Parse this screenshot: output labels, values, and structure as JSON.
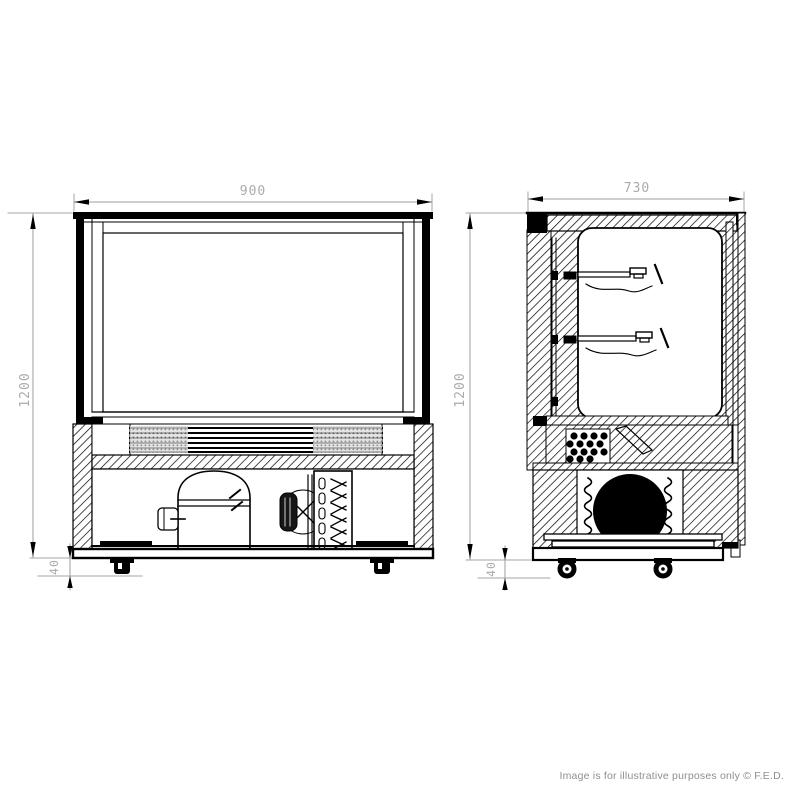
{
  "colors": {
    "background": "#ffffff",
    "drawing_line": "#000000",
    "dimension_gray": "#a6a6a6",
    "watermark_gray": "#8f8f8f"
  },
  "front_view": {
    "width_label": "900",
    "height_label": "1200",
    "castor_height_label": "40"
  },
  "side_view": {
    "depth_label": "730",
    "height_label": "1200",
    "castor_height_label": "40"
  },
  "watermark": {
    "text": "Image is for illustrative purposes only © F.E.D."
  }
}
